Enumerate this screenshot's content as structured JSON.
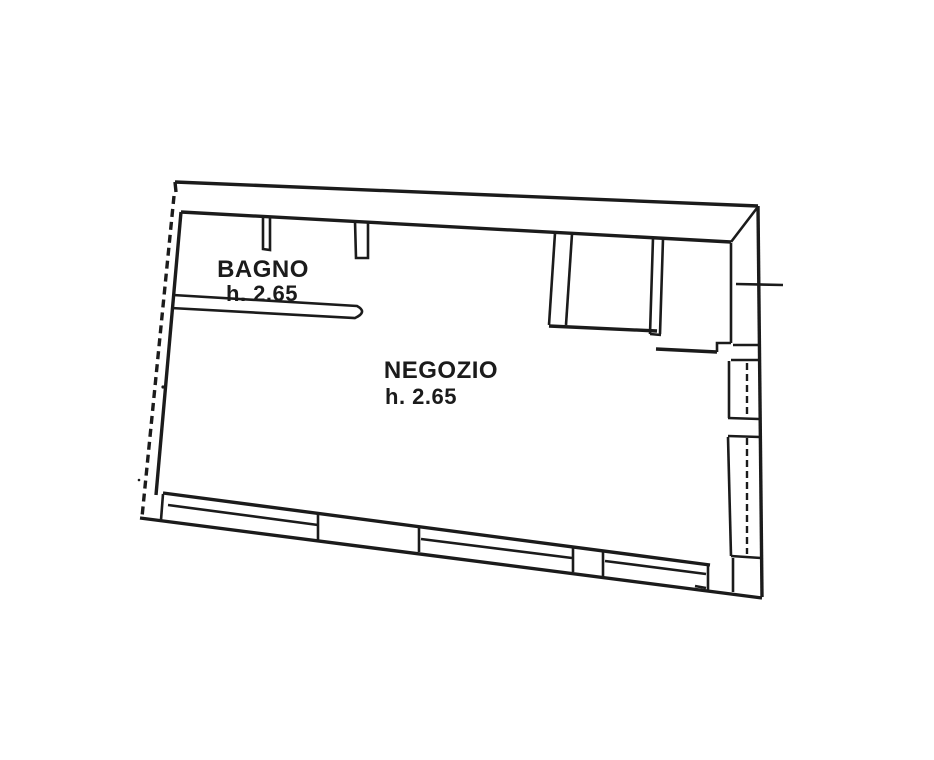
{
  "document": {
    "type": "scanned cadastral floor plan",
    "background_color": "#ffffff",
    "line_color": "#1b1b1b"
  },
  "rooms": {
    "bagno": {
      "label": "BAGNO",
      "height_label": "h. 2.65"
    },
    "negozio": {
      "label": "NEGOZIO",
      "height_label": "h. 2.65"
    }
  }
}
